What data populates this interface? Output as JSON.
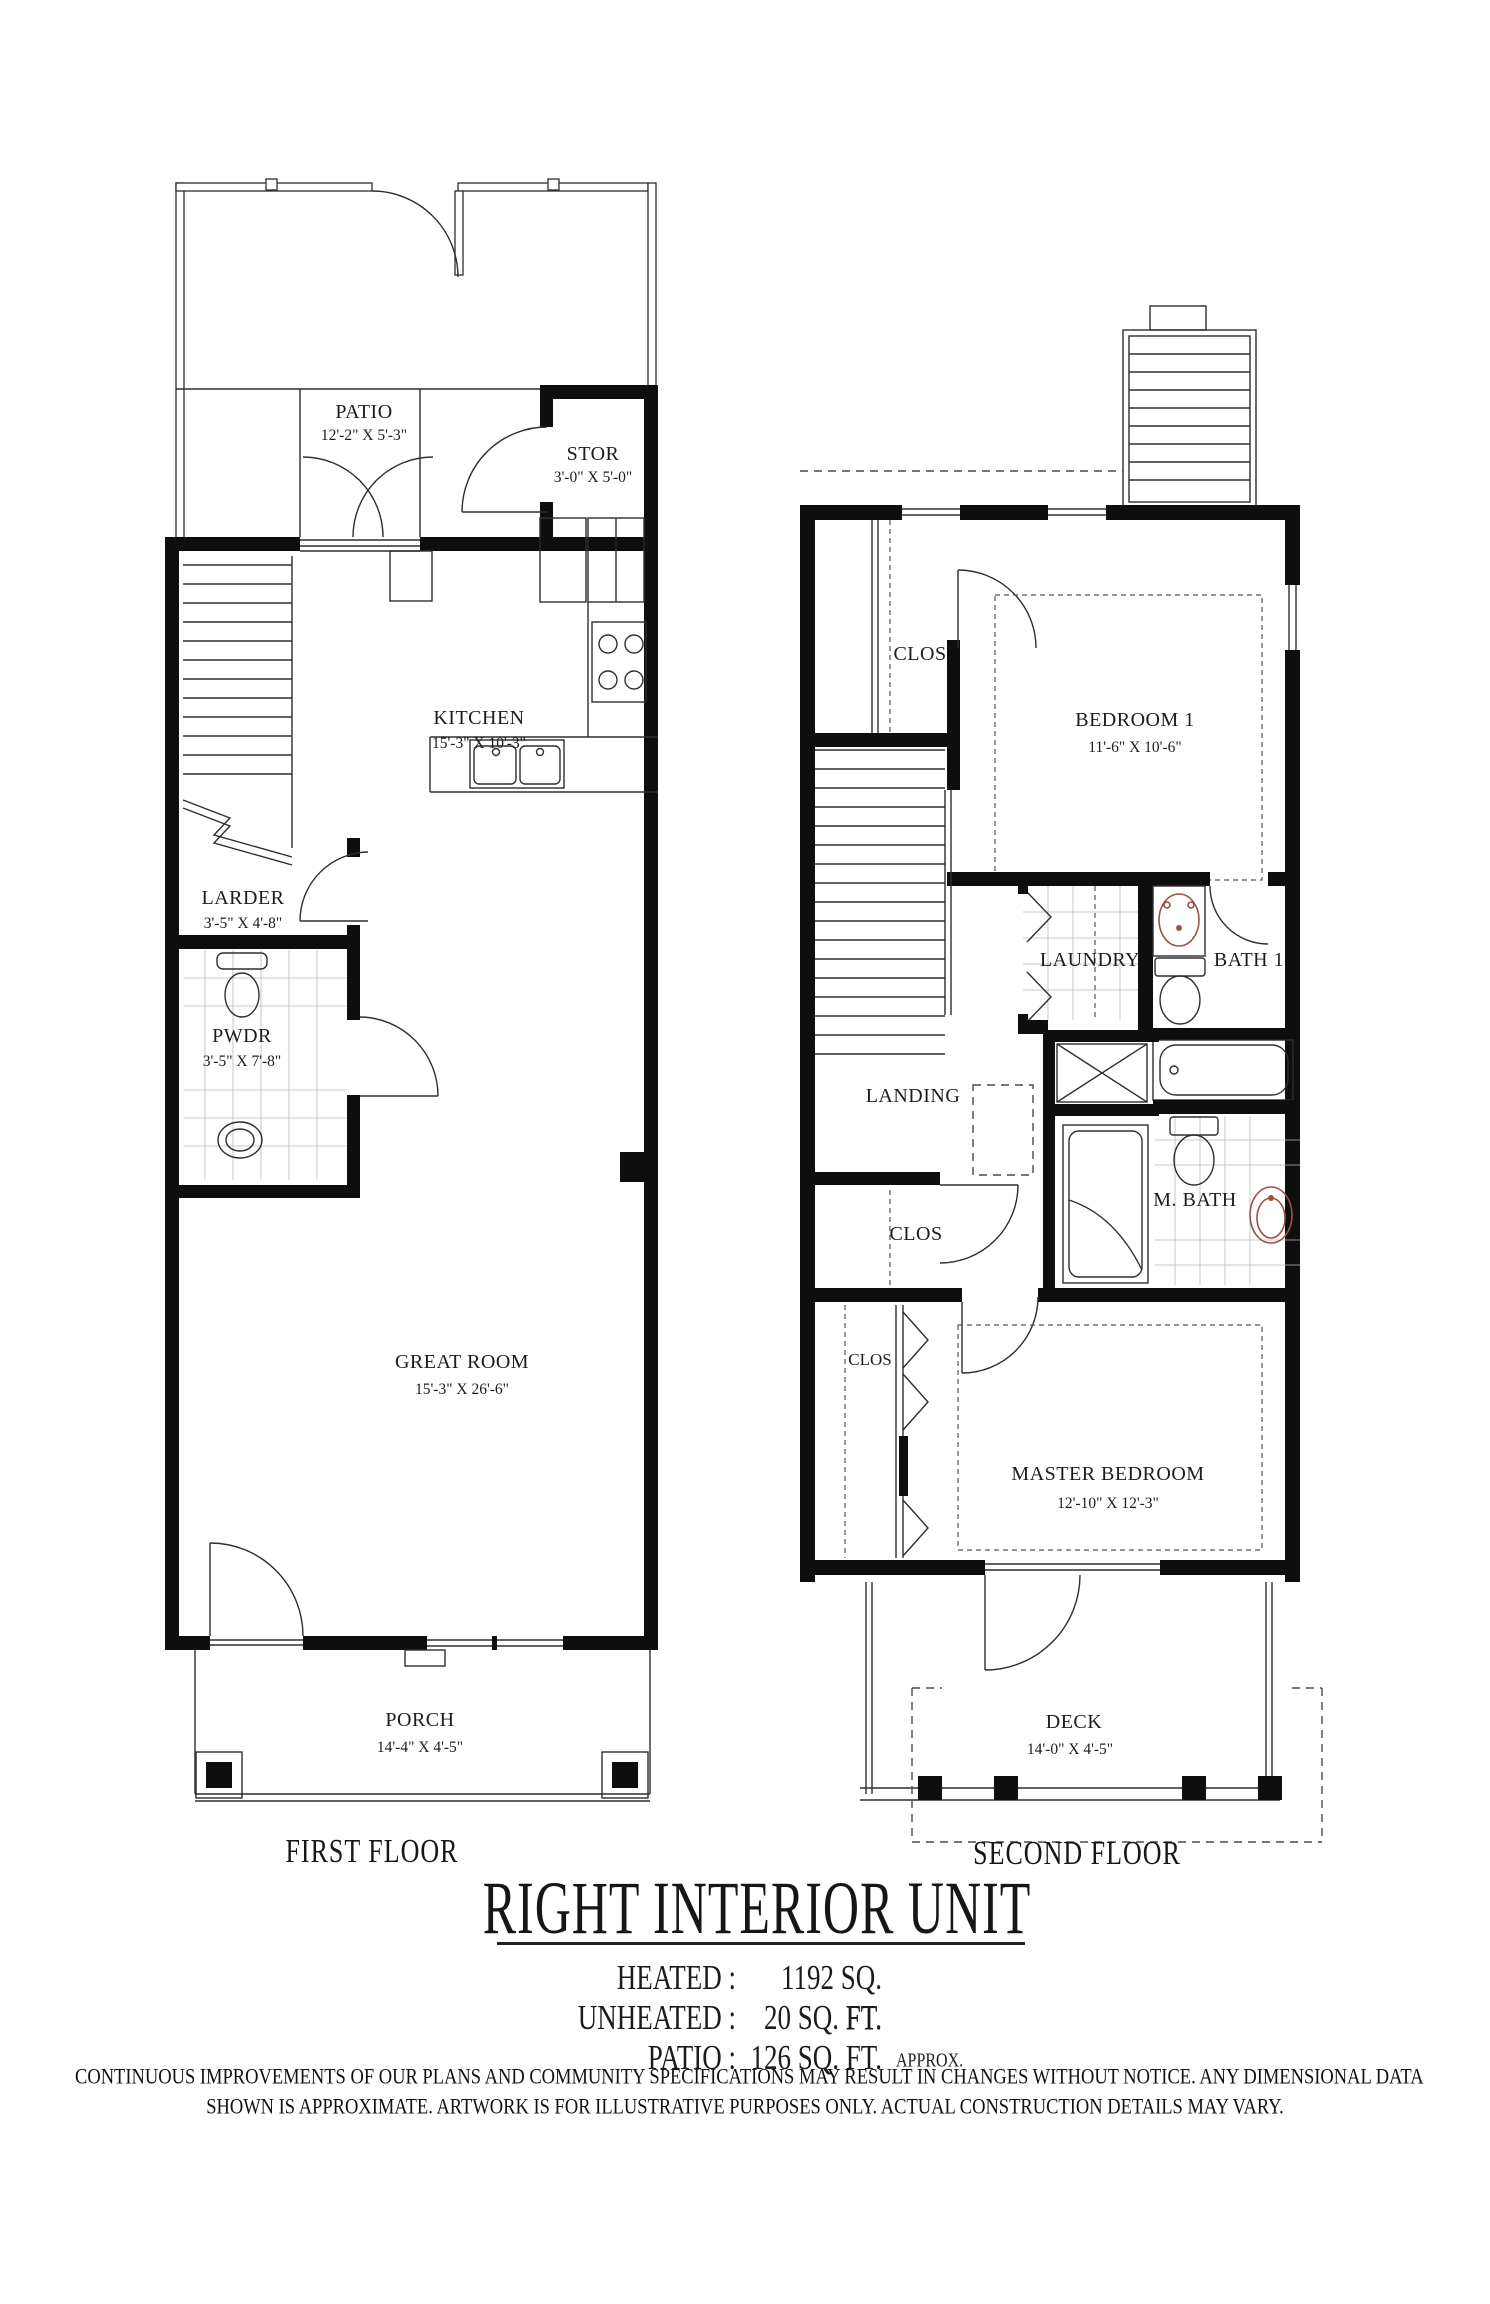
{
  "document": {
    "title": "RIGHT INTERIOR UNIT",
    "stats": [
      {
        "label": "HEATED :",
        "value": "1192 SQ. FT.",
        "suffix": ""
      },
      {
        "label": "UNHEATED :",
        "value": "20 SQ. FT.",
        "suffix": ""
      },
      {
        "label": "PATIO :",
        "value": "126 SQ. FT.",
        "suffix": "APPROX."
      }
    ],
    "disclaimer_line1": "CONTINUOUS IMPROVEMENTS OF OUR PLANS AND COMMUNITY SPECIFICATIONS MAY RESULT IN CHANGES WITHOUT NOTICE.  ANY DIMENSIONAL DATA",
    "disclaimer_line2": "SHOWN IS APPROXIMATE.  ARTWORK IS FOR ILLUSTRATIVE PURPOSES ONLY.  ACTUAL CONSTRUCTION DETAILS MAY VARY."
  },
  "first_floor": {
    "caption": "FIRST FLOOR",
    "rooms": {
      "patio": {
        "name": "PATIO",
        "dims": "12'-2\" X 5'-3\""
      },
      "stor": {
        "name": "STOR",
        "dims": "3'-0\" X 5'-0\""
      },
      "kitchen": {
        "name": "KITCHEN",
        "dims": "15'-3\" X 10'-3\""
      },
      "larder": {
        "name": "LARDER",
        "dims": "3'-5\" X 4'-8\""
      },
      "pwdr": {
        "name": "PWDR",
        "dims": "3'-5\" X 7'-8\""
      },
      "great_room": {
        "name": "GREAT ROOM",
        "dims": "15'-3\" X  26'-6\""
      },
      "porch": {
        "name": "PORCH",
        "dims": "14'-4\" X 4'-5\""
      }
    }
  },
  "second_floor": {
    "caption": "SECOND FLOOR",
    "rooms": {
      "clos_top": {
        "name": "CLOS"
      },
      "bedroom1": {
        "name": "BEDROOM 1",
        "dims": "11'-6\" X 10'-6\""
      },
      "laundry": {
        "name": "LAUNDRY"
      },
      "bath1": {
        "name": "BATH 1"
      },
      "landing": {
        "name": "LANDING"
      },
      "clos_mid": {
        "name": "CLOS"
      },
      "m_bath": {
        "name": "M. BATH"
      },
      "clos_master": {
        "name": "CLOS"
      },
      "master_bedroom": {
        "name": "MASTER BEDROOM",
        "dims": "12'-10\" X 12'-3\""
      },
      "deck": {
        "name": "DECK",
        "dims": "14'-0\" X 4'-5\""
      }
    }
  },
  "colors": {
    "wall": "#0e0e0e",
    "line": "#2e2e2e",
    "fixture_accent": "#9a5148",
    "background": "#ffffff"
  }
}
